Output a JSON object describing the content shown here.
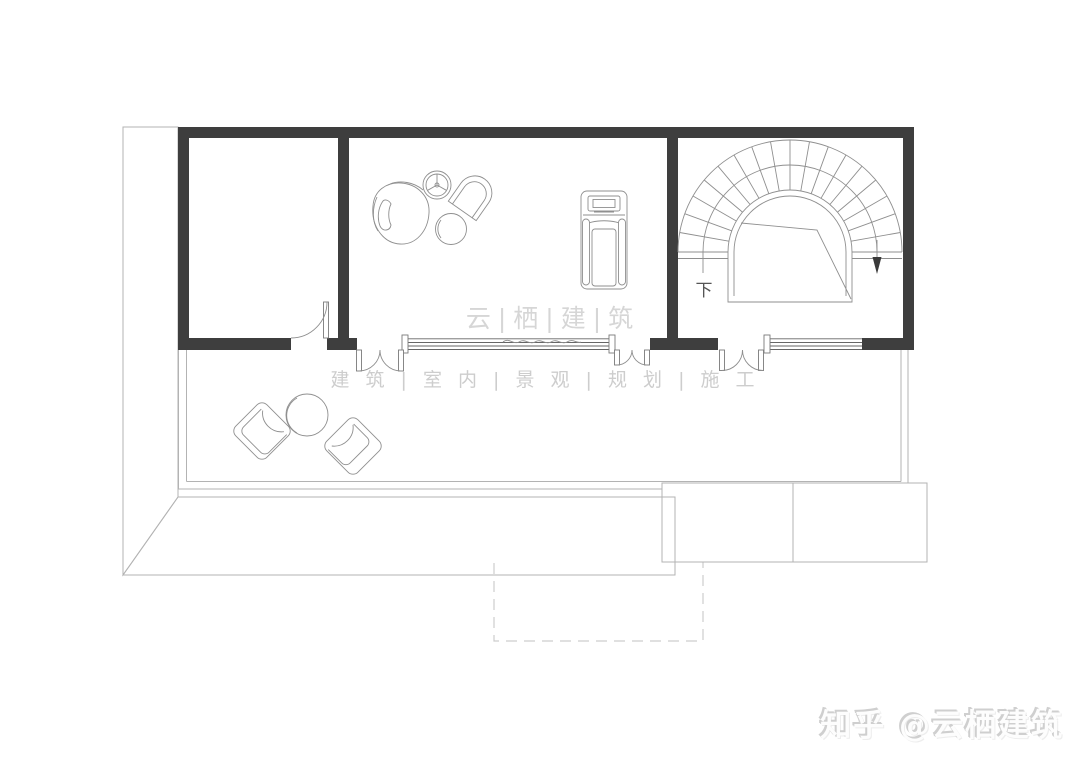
{
  "page": {
    "background": "#ffffff"
  },
  "watermarks": {
    "brand": "云|栖|建|筑",
    "services": "建 筑 | 室 内 | 景 观 | 规 划 | 施 工",
    "credit": "知乎 @云栖建筑"
  },
  "plan": {
    "type": "residential-floor-plan",
    "stair": {
      "direction_label": "下"
    },
    "elements": [
      "spiral-stair",
      "treadmill",
      "lounge-chair",
      "side-table",
      "arch-armchair",
      "ottoman",
      "patio-armchair-left",
      "patio-table",
      "patio-armchair-right",
      "roof-tiles-left",
      "roof-tiles-bottom",
      "roof-tiles-right",
      "terrace",
      "foundation-dashed-outline",
      "double-doors",
      "windows"
    ],
    "colors": {
      "wall": "#3e3e3e",
      "line": "#8f8f8f",
      "faint": "#b3b3b3",
      "watermark_primary": "#d6d6d6",
      "watermark_secondary": "#cdcdcd",
      "background": "#ffffff"
    }
  }
}
